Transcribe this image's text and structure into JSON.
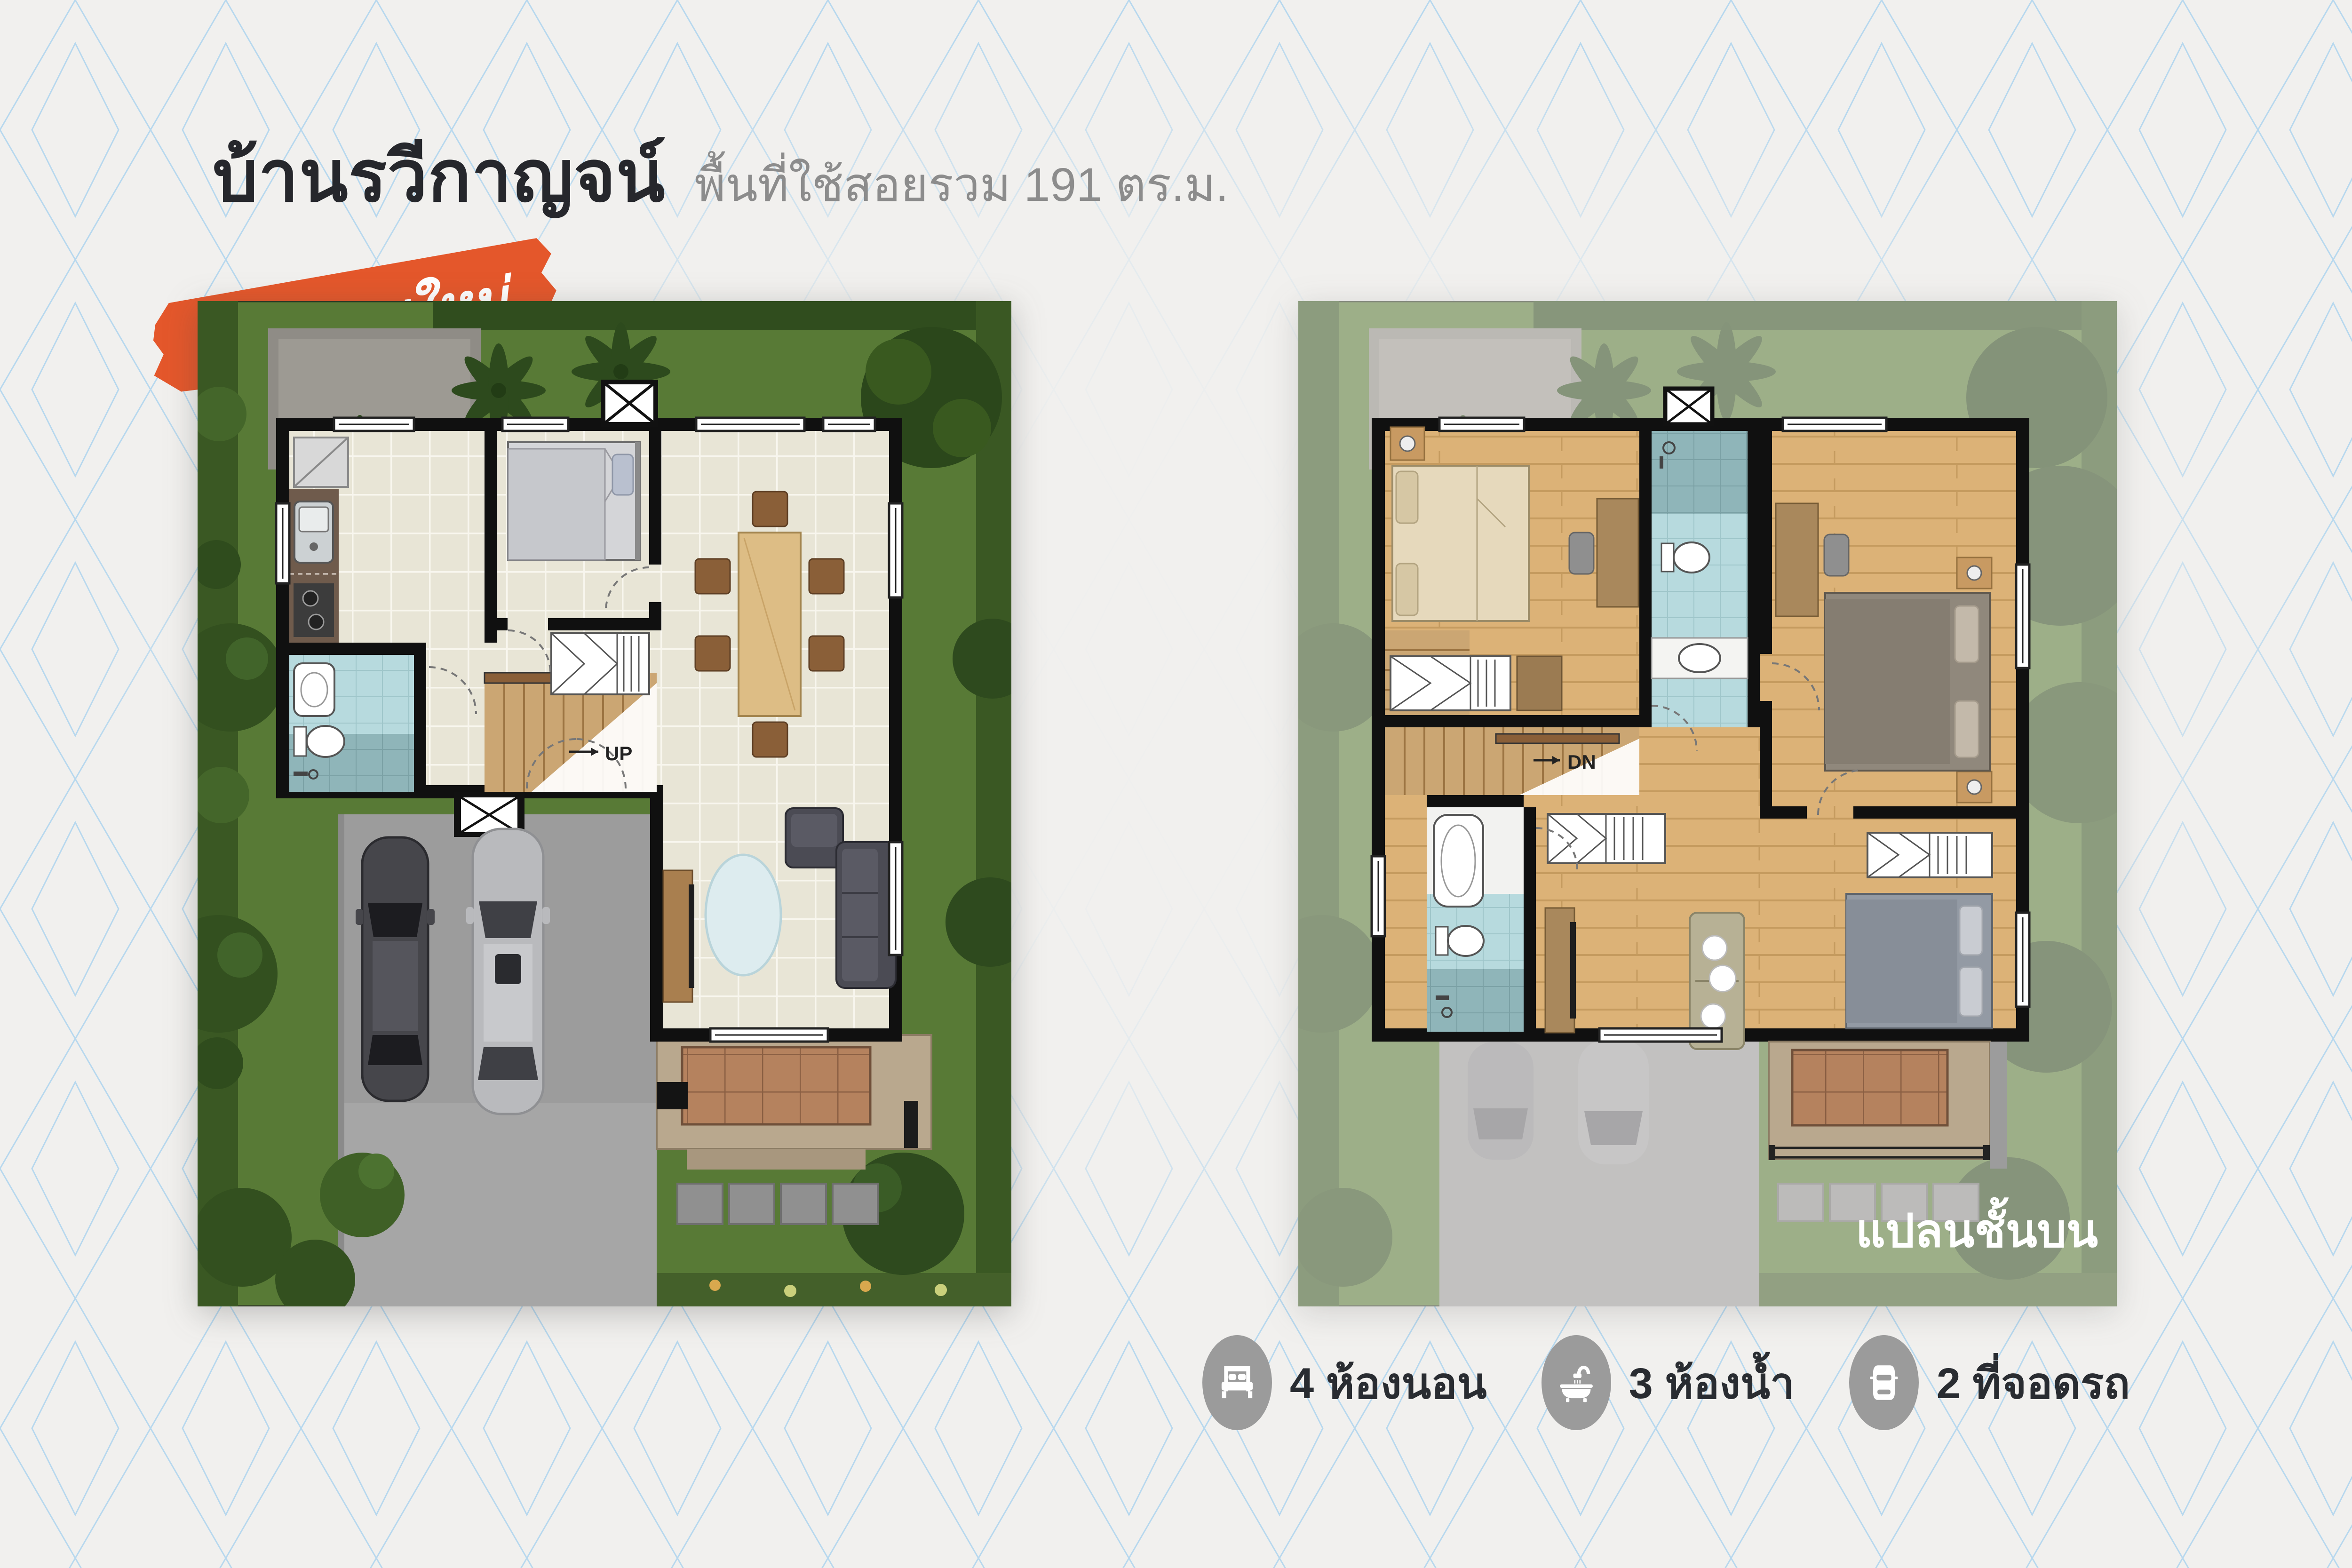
{
  "header": {
    "title": "บ้านรวีกาญจน์",
    "subtitle": "พื้นที่ใช้สอยรวม 191 ตร.ม."
  },
  "badge": {
    "text_regular": "บ้าน",
    "text_bold": "แบบใหม่"
  },
  "plans": {
    "ground": {
      "stair_label": "UP"
    },
    "upper": {
      "stair_label": "DN",
      "caption": "แปลนชั้นบน"
    }
  },
  "stats": [
    {
      "icon": "bed-icon",
      "label": "4 ห้องนอน"
    },
    {
      "icon": "bathtub-icon",
      "label": "3 ห้องน้ำ"
    },
    {
      "icon": "car-icon",
      "label": "2 ที่จอดรถ"
    }
  ],
  "colors": {
    "badge_orange": "#e4572b",
    "pattern_blue": "#b7d8ee",
    "title_dark": "#26272c",
    "subtitle_gray": "#8c8c8c",
    "stat_circle_gray": "#9b9b9b",
    "lawn_green": "#587a36",
    "wall_black": "#101010"
  }
}
